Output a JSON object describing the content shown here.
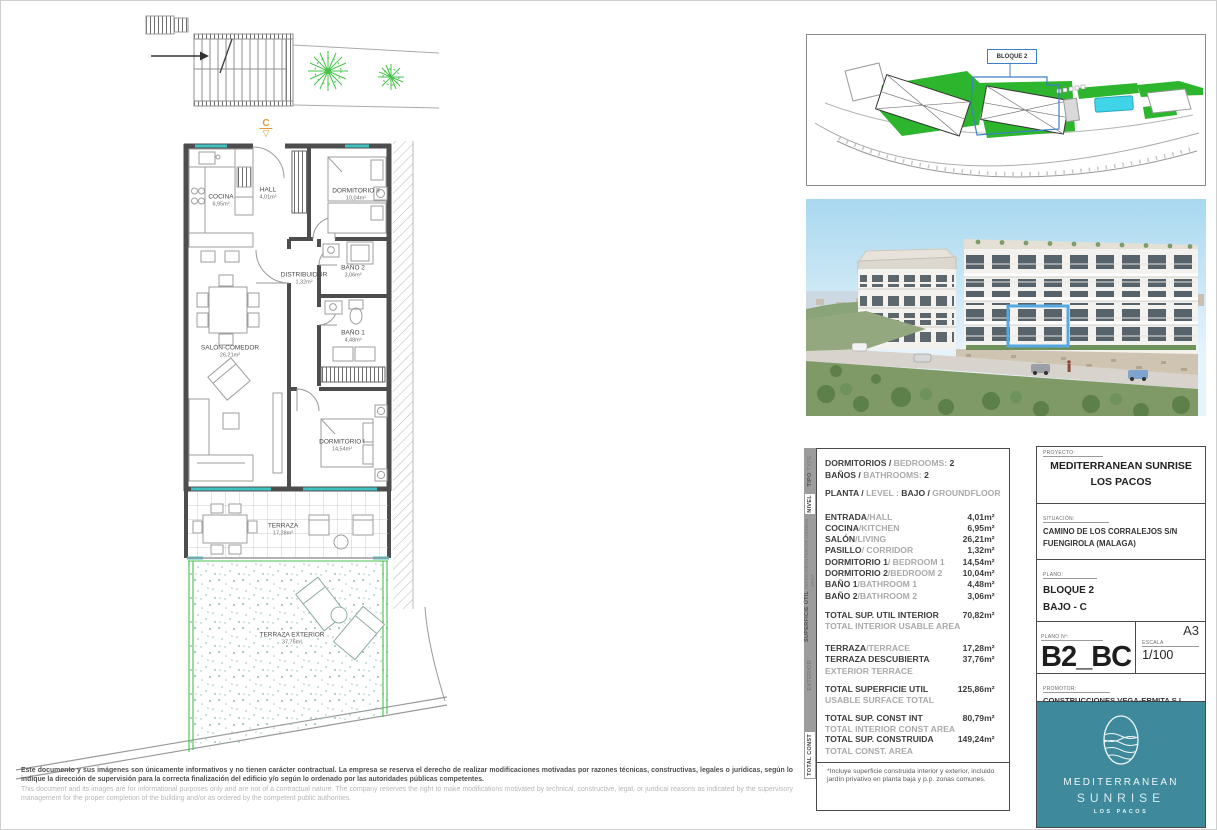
{
  "plan": {
    "section_marker": "C",
    "section_arrow_icon": "▽",
    "rooms": [
      {
        "name": "COCINA",
        "area": "6,95m²"
      },
      {
        "name": "HALL",
        "area": "4,01m²"
      },
      {
        "name": "DORMITORIO II",
        "area": "10,04m²"
      },
      {
        "name": "DISTRIBUIDOR",
        "area": "1,32m²"
      },
      {
        "name": "BAÑO 2",
        "area": "3,06m²"
      },
      {
        "name": "BAÑO 1",
        "area": "4,48m²"
      },
      {
        "name": "SALÓN-COMEDOR",
        "area": "26,21m²"
      },
      {
        "name": "DORMITORIO I",
        "area": "14,54m²"
      },
      {
        "name": "TERRAZA",
        "area": "17,28m²"
      },
      {
        "name": "TERRAZA EXTERIOR",
        "area": "37,76m²"
      }
    ]
  },
  "site_plan": {
    "block_label": "BLOQUE 2"
  },
  "area_table": {
    "side_tabs": [
      {
        "es": "TIPO",
        "en": "TYPE"
      },
      {
        "es": "NIVEL",
        "en": ""
      },
      {
        "es": "SUPERFICIE ÚTIL",
        "en": "INTERIOR/INTERIOR USABLE AREA"
      },
      {
        "es": "EXTERIOR",
        "en": ""
      },
      {
        "es": "TOTAL CONST",
        "en": ""
      }
    ],
    "header": {
      "row1_es": "DORMITORIOS / ",
      "row1_en": "BEDROOMS: ",
      "row1_val": "2",
      "row2_es": "BAÑOS / ",
      "row2_en": "BATHROOMS: ",
      "row2_val": "2",
      "row3_es1": "PLANTA / ",
      "row3_en1": "LEVEL : ",
      "row3_es2": "BAJO / ",
      "row3_en2": "GROUNDFLOOR"
    },
    "rows": [
      {
        "es": "ENTRADA",
        "en": "/HALL",
        "val": "4,01m²"
      },
      {
        "es": "COCINA",
        "en": "/KITCHEN",
        "val": "6,95m²"
      },
      {
        "es": "SALÓN",
        "en": "/LIVING",
        "val": "26,21m²"
      },
      {
        "es": "PASILLO",
        "en": "/ CORRIDOR",
        "val": "1,32m²"
      },
      {
        "es": "DORMITORIO 1",
        "en": "/ BEDROOM 1",
        "val": "14,54m²"
      },
      {
        "es": "DORMITORIO 2",
        "en": "/BEDROOM 2",
        "val": "10,04m²"
      },
      {
        "es": "BAÑO 1",
        "en": "/BATHROOM 1",
        "val": "4,48m²"
      },
      {
        "es": "BAÑO 2",
        "en": "/BATHROOM 2",
        "val": "3,06m²"
      }
    ],
    "total_interior": {
      "es": "TOTAL SUP. UTIL INTERIOR",
      "val": "70,82m²",
      "sub": "TOTAL INTERIOR USABLE AREA"
    },
    "terrace": {
      "es": "TERRAZA",
      "en": "/TERRACE",
      "val": "17,28m²"
    },
    "terrace_open": {
      "es": "TERRAZA DESCUBIERTA",
      "val": "37,76m²",
      "sub": "EXTERIOR TERRACE"
    },
    "total_usable": {
      "es": "TOTAL SUPERFICIE UTIL",
      "val": "125,86m²",
      "sub": "USABLE SURFACE TOTAL"
    },
    "total_const_int": {
      "es": "TOTAL SUP. CONST INT",
      "val": "80,79m²",
      "sub": "TOTAL INTERIOR CONST AREA"
    },
    "total_const": {
      "es": "TOTAL SUP. CONSTRUIDA",
      "val": "149,24m²",
      "sub": "TOTAL CONST. AREA"
    },
    "footnote": "*Incluye superficie construida interior y exterior, incluido jardín privativo en planta baja y p.p. zonas comunes."
  },
  "title_block": {
    "proyecto_label": "PROYECTO:",
    "proyecto_line1": "MEDITERRANEAN SUNRISE",
    "proyecto_line2": "LOS PACOS",
    "situacion_label": "SITUACIÓN:",
    "situacion_line1": "CAMINO DE LOS CORRALEJOS S/N",
    "situacion_line2": "FUENGIROLA (MALAGA)",
    "plano_label": "PLANO:",
    "plano_line1": "BLOQUE 2",
    "plano_line2": "BAJO - C",
    "plano_num_label": "PLANO Nº:",
    "plano_num": "B2_BC",
    "sheet_size": "A3",
    "escala_label": "ESCALA",
    "escala": "1/100",
    "promotor_label": "PROMOTOR:",
    "promotor": "CONSTRUCCIONES VEGA-ERMITA S.L.",
    "logo_line1": "MEDITERRANEAN",
    "logo_line2": "SUNRISE",
    "logo_line3": "LOS PACOS"
  },
  "disclaimer": {
    "es": "Este documento y sus imágenes son únicamente informativos y no tienen carácter contractual. La empresa se reserva el derecho de realizar modificaciones motivadas por razones técnicas, constructivas, legales o jurídicas, según lo indique la dirección de supervisión para la correcta finalización del edificio y/o según lo ordenado por las autoridades públicas competentes.",
    "en": "This document and its images are for informational purposes only and are not of a contractual nature. The company reserves the right to make modifications motivated by technical, constructive, legal, or juridical reasons as indicated by the supervisory management for the proper completion of the building and/or as ordered by the competent public authorities."
  },
  "colors": {
    "logo_teal": "#3e8a9c",
    "plan_green": "#2db52d",
    "highlight_blue": "#56a8e2",
    "marker_orange": "#e09a3c",
    "glazing_teal": "#3fc1c1",
    "pool_cyan": "#3fd4e8"
  }
}
